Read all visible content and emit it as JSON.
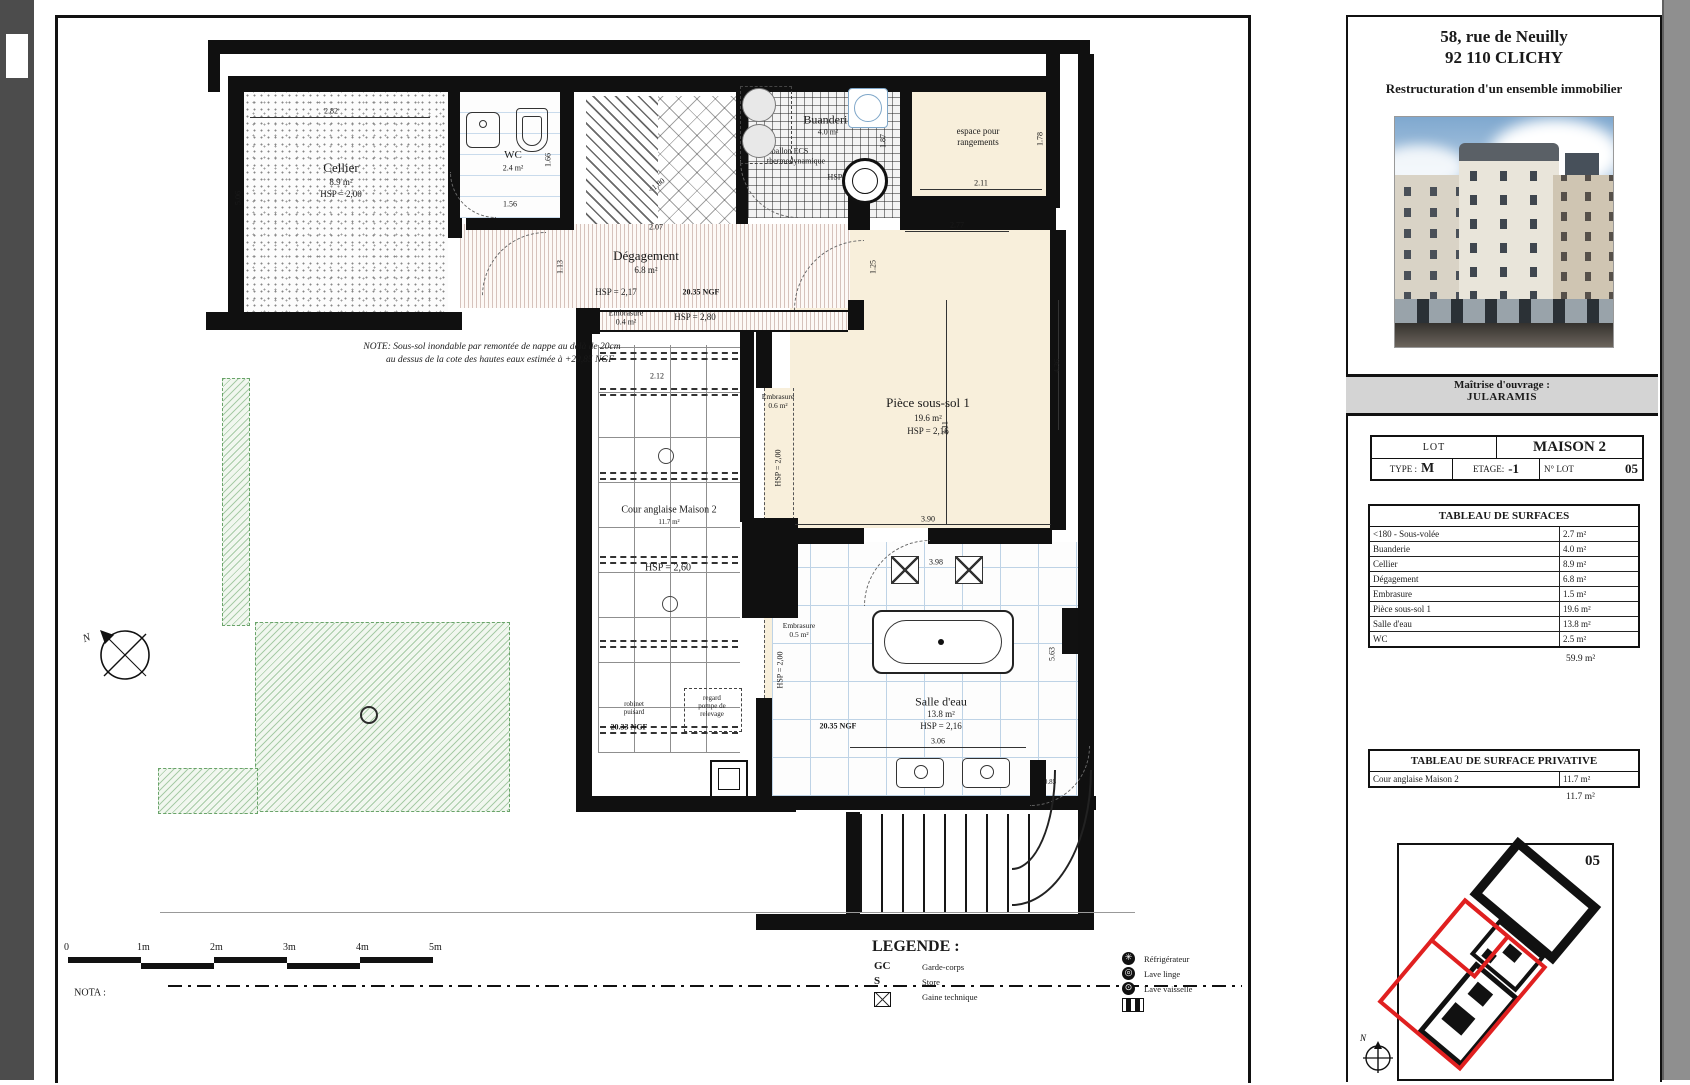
{
  "title_block": {
    "address1": "58, rue de Neuilly",
    "address2": "92 110 CLICHY",
    "project": "Restructuration d'un ensemble immobilier",
    "owner_label": "Maîtrise d'ouvrage :",
    "owner": "JULARAMIS",
    "lot": {
      "lot_label": "LOT",
      "lot_name": "MAISON 2",
      "type_label": "TYPE :",
      "type_value": "M",
      "etage_label": "ETAGE:",
      "etage_value": "-1",
      "num_label": "N° LOT",
      "num_value": "05"
    },
    "surfaces": {
      "title": "TABLEAU DE SURFACES",
      "rows": [
        {
          "label": "<180 - Sous-volée",
          "value": "2.7 m²"
        },
        {
          "label": "Buanderie",
          "value": "4.0 m²"
        },
        {
          "label": "Cellier",
          "value": "8.9 m²"
        },
        {
          "label": "Dégagement",
          "value": "6.8 m²"
        },
        {
          "label": "Embrasure",
          "value": "1.5 m²"
        },
        {
          "label": "Pièce sous-sol 1",
          "value": "19.6 m²"
        },
        {
          "label": "Salle d'eau",
          "value": "13.8 m²"
        },
        {
          "label": "WC",
          "value": "2.5 m²"
        }
      ],
      "total": "59.9 m²"
    },
    "privative": {
      "title": "TABLEAU DE SURFACE PRIVATIVE",
      "rows": [
        {
          "label": "Cour anglaise Maison 2",
          "value": "11.7 m²"
        }
      ],
      "total": "11.7 m²"
    },
    "key_plan": {
      "lot_number": "05",
      "north": "N"
    }
  },
  "plan": {
    "north": "N",
    "labels": [
      {
        "n": "room-label-cellier",
        "t": "Cellier",
        "x": 341,
        "y": 168,
        "fs": 13
      },
      {
        "n": "room-area-cellier",
        "t": "8.9 m²",
        "x": 341,
        "y": 183,
        "fs": 9
      },
      {
        "n": "room-hsp-cellier",
        "t": "HSP = 2,00",
        "x": 341,
        "y": 195,
        "fs": 9
      },
      {
        "n": "room-label-wc",
        "t": "WC",
        "x": 513,
        "y": 156,
        "fs": 11
      },
      {
        "n": "room-area-wc",
        "t": "2.4 m²",
        "x": 513,
        "y": 169,
        "fs": 8
      },
      {
        "n": "room-label-degagement",
        "t": "Dégagement",
        "x": 646,
        "y": 256,
        "fs": 13
      },
      {
        "n": "room-area-degagement",
        "t": "6.8 m²",
        "x": 646,
        "y": 271,
        "fs": 9
      },
      {
        "n": "room-hsp-degagement",
        "t": "HSP = 2,17",
        "x": 616,
        "y": 293,
        "fs": 9
      },
      {
        "n": "level-ngf-degagement",
        "t": "20.35 NGF",
        "x": 701,
        "y": 293,
        "fs": 8,
        "b": 1
      },
      {
        "n": "room-label-buanderie",
        "t": "Buanderie",
        "x": 828,
        "y": 120,
        "fs": 12
      },
      {
        "n": "room-area-buanderie",
        "t": "4.0 m²",
        "x": 828,
        "y": 133,
        "fs": 8
      },
      {
        "n": "annotation-ballon-1",
        "t": "ballon ECS",
        "x": 790,
        "y": 152,
        "fs": 8
      },
      {
        "n": "annotation-ballon-2",
        "t": "thermodynamique",
        "x": 796,
        "y": 162,
        "fs": 8
      },
      {
        "n": "room-hsp-buanderie",
        "t": "HSP = 1,80",
        "x": 846,
        "y": 178,
        "fs": 8
      },
      {
        "n": "room-label-espace-1",
        "t": "espace pour",
        "x": 978,
        "y": 132,
        "fs": 9
      },
      {
        "n": "room-label-espace-2",
        "t": "rangements",
        "x": 978,
        "y": 143,
        "fs": 9
      },
      {
        "n": "room-label-piece",
        "t": "Pièce sous-sol 1",
        "x": 928,
        "y": 403,
        "fs": 13
      },
      {
        "n": "room-area-piece",
        "t": "19.6 m²",
        "x": 928,
        "y": 419,
        "fs": 9
      },
      {
        "n": "room-hsp-piece",
        "t": "HSP = 2,16",
        "x": 928,
        "y": 432,
        "fs": 9
      },
      {
        "n": "room-label-salle",
        "t": "Salle d'eau",
        "x": 941,
        "y": 702,
        "fs": 12
      },
      {
        "n": "room-area-salle",
        "t": "13.8 m²",
        "x": 941,
        "y": 715,
        "fs": 9
      },
      {
        "n": "room-hsp-salle",
        "t": "HSP = 2,16",
        "x": 941,
        "y": 727,
        "fs": 9
      },
      {
        "n": "level-ngf-salle",
        "t": "20.35 NGF",
        "x": 838,
        "y": 727,
        "fs": 8,
        "b": 1
      },
      {
        "n": "room-label-cour",
        "t": "Cour anglaise Maison 2",
        "x": 669,
        "y": 511,
        "fs": 10
      },
      {
        "n": "room-area-cour",
        "t": "11.7 m²",
        "x": 669,
        "y": 523,
        "fs": 7
      },
      {
        "n": "room-hsp-cour",
        "t": "HSP = 2,60",
        "x": 668,
        "y": 569,
        "fs": 10
      },
      {
        "n": "level-ngf-cour",
        "t": "20.33 NGF",
        "x": 629,
        "y": 728,
        "fs": 8,
        "b": 1
      },
      {
        "n": "embrasure-band-label",
        "t": "Embrasure",
        "x": 626,
        "y": 314,
        "fs": 8
      },
      {
        "n": "embrasure-band-area",
        "t": "0.4 m²",
        "x": 626,
        "y": 323,
        "fs": 8
      },
      {
        "n": "embrasure-band-hsp",
        "t": "HSP = 2,80",
        "x": 695,
        "y": 318,
        "fs": 9
      },
      {
        "n": "embrasure-1-label",
        "t": "Embrasure",
        "x": 778,
        "y": 397,
        "fs": 7.5
      },
      {
        "n": "embrasure-1-area",
        "t": "0.6 m²",
        "x": 778,
        "y": 406,
        "fs": 7.5
      },
      {
        "n": "embrasure-1-hsp",
        "t": "HSP = 2,00",
        "x": 779,
        "y": 468,
        "fs": 8,
        "v": 1
      },
      {
        "n": "embrasure-2-label",
        "t": "Embrasure",
        "x": 799,
        "y": 626,
        "fs": 7.5
      },
      {
        "n": "embrasure-2-area",
        "t": "0.5 m²",
        "x": 799,
        "y": 635,
        "fs": 7.5
      },
      {
        "n": "embrasure-2-hsp",
        "t": "HSP = 2,00",
        "x": 781,
        "y": 670,
        "fs": 8,
        "v": 1
      },
      {
        "n": "sous-volee-label",
        "t": "<1,80",
        "x": 657,
        "y": 186,
        "fs": 8,
        "r": -38
      },
      {
        "n": "annotation-regard-1",
        "t": "regard",
        "x": 712,
        "y": 699,
        "fs": 7
      },
      {
        "n": "annotation-regard-2",
        "t": "pompe de",
        "x": 712,
        "y": 707,
        "fs": 7
      },
      {
        "n": "annotation-regard-3",
        "t": "relevage",
        "x": 712,
        "y": 715,
        "fs": 7
      },
      {
        "n": "annotation-robinet-1",
        "t": "robinet",
        "x": 634,
        "y": 705,
        "fs": 7
      },
      {
        "n": "annotation-robinet-2",
        "t": "puisard",
        "x": 634,
        "y": 713,
        "fs": 7
      },
      {
        "n": "dim",
        "t": "2.82",
        "x": 331,
        "y": 112,
        "fs": 8
      },
      {
        "n": "dim",
        "t": "5.06",
        "x": 239,
        "y": 198,
        "fs": 8,
        "v": 1
      },
      {
        "n": "dim",
        "t": "1.56",
        "x": 510,
        "y": 205,
        "fs": 8
      },
      {
        "n": "dim",
        "t": "1.66",
        "x": 549,
        "y": 160,
        "fs": 8,
        "v": 1
      },
      {
        "n": "dim",
        "t": "1.13",
        "x": 561,
        "y": 267,
        "fs": 8,
        "v": 1
      },
      {
        "n": "dim",
        "t": "2.07",
        "x": 656,
        "y": 228,
        "fs": 8
      },
      {
        "n": "dim",
        "t": "1.87",
        "x": 884,
        "y": 141,
        "fs": 8,
        "v": 1
      },
      {
        "n": "dim",
        "t": "2.11",
        "x": 981,
        "y": 184,
        "fs": 8
      },
      {
        "n": "dim",
        "t": "1.78",
        "x": 1041,
        "y": 139,
        "fs": 8,
        "v": 1
      },
      {
        "n": "dim",
        "t": "2.77",
        "x": 957,
        "y": 226,
        "fs": 8
      },
      {
        "n": "dim",
        "t": "1.25",
        "x": 874,
        "y": 267,
        "fs": 8,
        "v": 1
      },
      {
        "n": "dim",
        "t": "3.11",
        "x": 946,
        "y": 428,
        "fs": 8,
        "v": 1
      },
      {
        "n": "dim",
        "t": "4.36",
        "x": 1058,
        "y": 366,
        "fs": 8,
        "v": 1
      },
      {
        "n": "dim",
        "t": "3.90",
        "x": 928,
        "y": 520,
        "fs": 8
      },
      {
        "n": "dim",
        "t": "3.98",
        "x": 936,
        "y": 563,
        "fs": 8
      },
      {
        "n": "dim",
        "t": "3.06",
        "x": 938,
        "y": 742,
        "fs": 8
      },
      {
        "n": "dim",
        "t": "5.63",
        "x": 1053,
        "y": 654,
        "fs": 8,
        "v": 1
      },
      {
        "n": "dim",
        "t": "0.85",
        "x": 1050,
        "y": 783,
        "fs": 7
      },
      {
        "n": "dim",
        "t": "2.12",
        "x": 657,
        "y": 377,
        "fs": 8
      },
      {
        "n": "note-line-1",
        "t": "NOTE: Sous-sol inondable par remontée de nappe au delà de 20cm",
        "x": 492,
        "y": 347,
        "fs": 9.5,
        "i": 1
      },
      {
        "n": "note-line-2",
        "t": "au dessus de la cote des hautes eaux estimée à +20,85 NGF",
        "x": 500,
        "y": 360,
        "fs": 9.5,
        "i": 1
      },
      {
        "n": "nota-label",
        "t": "NOTA :",
        "x": 90,
        "y": 994,
        "fs": 10
      },
      {
        "n": "north-label",
        "t": "N",
        "x": 87,
        "y": 639,
        "fs": 11,
        "i": 1,
        "r": -20
      }
    ]
  },
  "legend": {
    "title": "LEGENDE :",
    "items": [
      {
        "key": "GC",
        "label": "Garde-corps"
      },
      {
        "key": "S",
        "label": "Store"
      },
      {
        "key": "gaine-icon",
        "label": "Gaine technique"
      }
    ],
    "appliances": [
      {
        "icon": "refrigerator-icon",
        "glyph": "✳",
        "label": "Réfrigérateur"
      },
      {
        "icon": "washing-machine-icon",
        "glyph": "◎",
        "label": "Lave linge"
      },
      {
        "icon": "dishwasher-icon",
        "glyph": "⊙",
        "label": "Lave vaisselle"
      },
      {
        "icon": "technical-duct-icon",
        "glyph": "",
        "label": ""
      }
    ]
  },
  "scale_bar": {
    "ticks": [
      "0",
      "1m",
      "2m",
      "3m",
      "4m",
      "5m"
    ]
  }
}
